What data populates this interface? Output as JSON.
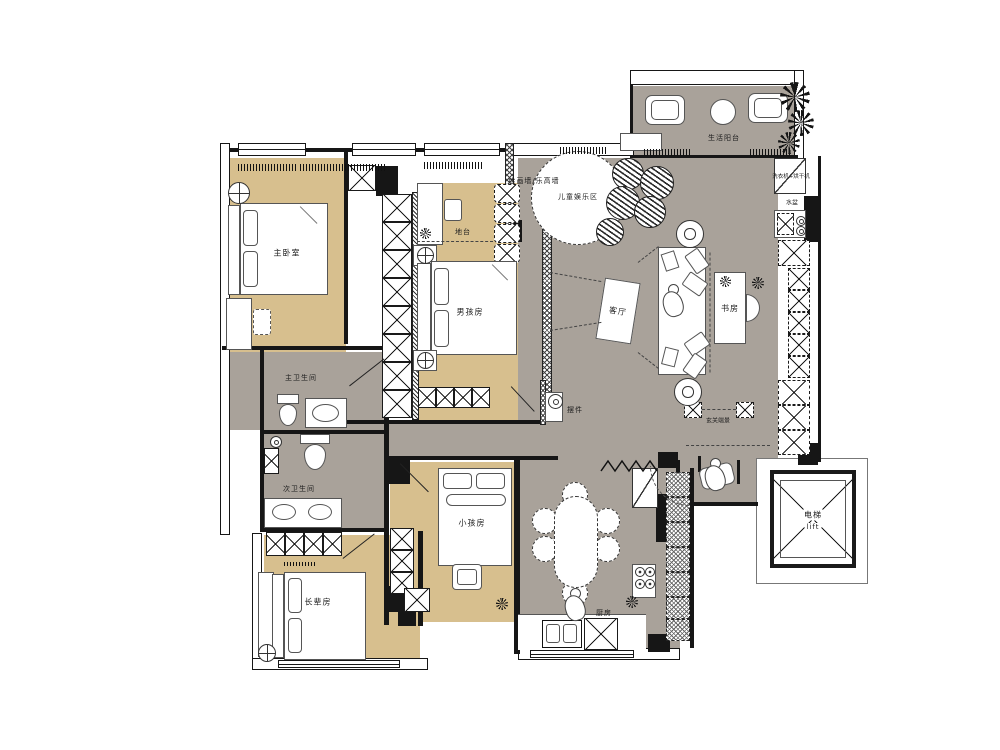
{
  "title": "apartment-floor-plan",
  "colors": {
    "floor_tan": "#d7bf8e",
    "floor_gray": "#a9a29a",
    "wall": "#161616"
  },
  "rooms": {
    "master_bedroom": {
      "label": "主卧室"
    },
    "boys_room": {
      "label": "男孩房"
    },
    "kids_room": {
      "label": "小孩房"
    },
    "elders_room": {
      "label": "长辈房"
    },
    "living_room": {
      "label": "客厅"
    },
    "study": {
      "label": "书房"
    },
    "kitchen": {
      "label": "厨房"
    },
    "master_bathroom": {
      "label": "主卫生间"
    },
    "second_bathroom": {
      "label": "次卫生间"
    },
    "balcony": {
      "label": "生活阳台"
    },
    "elevator": {
      "label": "电梯",
      "label_en": "lift"
    }
  },
  "annotations": {
    "play_area": "儿童娱乐区",
    "paint_wall": "绘画墙/乐高墙",
    "platform": "地台",
    "ornament": "摆件",
    "entry_view": "玄关端景",
    "basin": "水盆",
    "washer_dryer": "洗衣机+烘干机"
  }
}
